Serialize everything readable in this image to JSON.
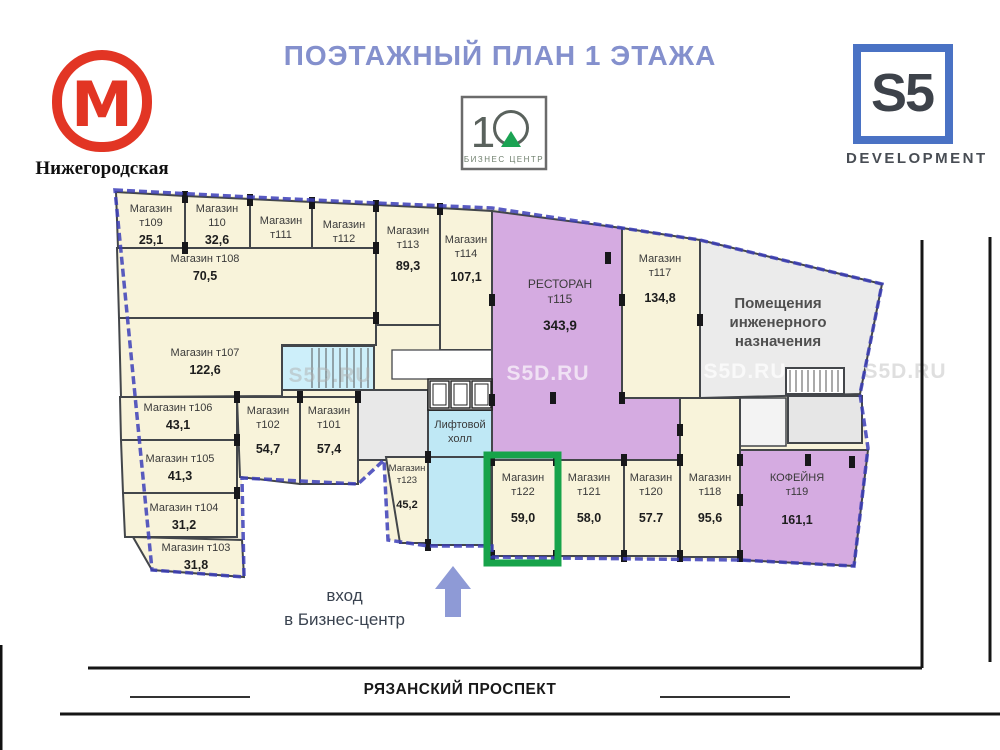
{
  "header": {
    "title": "ПОЭТАЖНЫЙ ПЛАН 1 ЭТАЖА",
    "metro": {
      "letter": "М",
      "station": "Нижегородская"
    },
    "business_center": {
      "digit": "1",
      "caption": "БИЗНЕС ЦЕНТР"
    },
    "developer": {
      "name": "S5",
      "caption": "DEVELOPMENT"
    }
  },
  "entrance": {
    "line1": "вход",
    "line2": "в Бизнес-центр"
  },
  "street": {
    "name": "РЯЗАНСКИЙ ПРОСПЕКТ"
  },
  "watermark_text": "S5D.RU",
  "colors": {
    "metro_red": "#e23524",
    "title_blue": "#8490cd",
    "accent_green": "#17a34a",
    "wall": "#43464a",
    "outline_blue": "#3c3eb8",
    "cream": "#f8f3da",
    "purple": "#d5abe1",
    "gray": "#ebebeb",
    "cyan": "#bfe8f5",
    "arrow_blue": "#8e9ad6"
  },
  "plan": {
    "outline": "115,190 250,197 376,203 492,208 622,228 700,240 882,284 860,394 868,448 854,566 740,560 556,558 492,557 492,546 428,546 388,540 384,460 358,484 242,478 244,577 152,570",
    "rooms": [
      {
        "id": "t109",
        "f": "cream",
        "p": "116,192 185,196 185,248 118,248",
        "n": [
          "Магазин",
          "т109"
        ],
        "a": "25,1",
        "lx": 151,
        "ly": 212,
        "ao": 32
      },
      {
        "id": "t110",
        "f": "cream",
        "p": "185,196 250,199 250,248 185,248",
        "n": [
          "Магазин",
          "110"
        ],
        "a": "32,6",
        "lx": 217,
        "ly": 212,
        "ao": 32
      },
      {
        "id": "t111",
        "f": "cream",
        "p": "250,199 312,202 312,318 250,318",
        "n": [
          "Магазин",
          "т111"
        ],
        "a": "74,9",
        "lx": 281,
        "ly": 224,
        "ao": 36
      },
      {
        "id": "t112",
        "f": "cream",
        "p": "312,202 376,205 376,322 312,322",
        "n": [
          "Магазин",
          "т112"
        ],
        "a": "91,7",
        "lx": 344,
        "ly": 228
      },
      {
        "id": "t113",
        "f": "cream",
        "p": "376,205 440,208 440,325 376,325",
        "n": [
          "Магазин",
          "т113"
        ],
        "a": "89,3",
        "lx": 408,
        "ly": 234,
        "ao": 36
      },
      {
        "id": "t114",
        "f": "cream",
        "p": "440,208 492,211 492,350 440,350",
        "n": [
          "Магазин",
          "т114"
        ],
        "a": "107,1",
        "lx": 466,
        "ly": 243
      },
      {
        "id": "t108",
        "f": "cream",
        "p": "117,248 376,248 376,318 119,318",
        "n": [
          "Магазин т108"
        ],
        "a": "70,5",
        "lx": 205,
        "ly": 262
      },
      {
        "id": "t107",
        "f": "cream",
        "p": "119,318 376,318 376,345 282,345 282,396 121,397",
        "n": [
          "Магазин т107"
        ],
        "a": "122,6",
        "lx": 205,
        "ly": 356
      },
      {
        "id": "t106",
        "f": "cream",
        "p": "120,397 237,397 237,440 121,440",
        "n": [
          "Магазин т106"
        ],
        "a": "43,1",
        "lx": 178,
        "ly": 411
      },
      {
        "id": "t105",
        "f": "cream",
        "p": "121,440 237,440 237,493 123,493",
        "n": [
          "Магазин т105"
        ],
        "a": "41,3",
        "lx": 180,
        "ly": 462
      },
      {
        "id": "t104",
        "f": "cream",
        "p": "123,493 237,493 237,537 125,537",
        "n": [
          "Магазин т104"
        ],
        "a": "31,2",
        "lx": 184,
        "ly": 511
      },
      {
        "id": "t103",
        "f": "cream",
        "p": "133,537 242,540 244,577 152,570",
        "n": [
          "Магазин т103"
        ],
        "a": "31,8",
        "lx": 196,
        "ly": 551
      },
      {
        "id": "t102",
        "f": "cream",
        "p": "237,397 300,397 300,484 240,477",
        "n": [
          "Магазин",
          "т102"
        ],
        "a": "54,7",
        "lx": 268,
        "ly": 414,
        "ao": 39
      },
      {
        "id": "t101",
        "f": "cream",
        "p": "300,397 358,397 358,484 300,484",
        "n": [
          "Магазин",
          "т101"
        ],
        "a": "57,4",
        "lx": 329,
        "ly": 414,
        "ao": 39
      },
      {
        "id": "corridor-west",
        "f": "#e8e8e8",
        "p": "358,390 428,390 428,460 358,460",
        "n": [],
        "a": ""
      },
      {
        "id": "utility-north",
        "f": "#ffffff",
        "p": "392,350 492,350 492,379 392,379",
        "n": [],
        "a": "",
        "sw": 1.3
      },
      {
        "id": "stair-west",
        "f": "#cdeffa",
        "p": "282,346 374,346 374,390 282,390",
        "n": [],
        "a": ""
      },
      {
        "id": "lift-hall",
        "f": "cyan",
        "p": "428,410 492,410 492,457 428,457",
        "n": [
          "Лифтовой",
          "холл"
        ],
        "a": "",
        "lx": 460,
        "ly": 428
      },
      {
        "id": "corridor-south",
        "f": "cyan",
        "p": "428,457 490,457 490,545 428,545",
        "n": [],
        "a": ""
      },
      {
        "id": "t123",
        "f": "cream",
        "p": "386,457 428,457 428,543 400,543",
        "n": [
          "Магазин",
          "т123"
        ],
        "a": "45,2",
        "lx": 407,
        "ly": 471,
        "fs": 9.5,
        "ao": 37
      },
      {
        "id": "restaurant-t115",
        "f": "purple",
        "p": "492,211 622,228 622,398 680,398 680,460 492,460",
        "n": [
          "РЕСТОРАН",
          "т115"
        ],
        "a": "343,9",
        "lx": 560,
        "ly": 288,
        "fs": 12,
        "ao": 42
      },
      {
        "id": "t117",
        "f": "cream",
        "p": "622,228 700,240 700,398 622,398",
        "n": [
          "Магазин",
          "т117"
        ],
        "a": "134,8",
        "lx": 660,
        "ly": 262,
        "ao": 40
      },
      {
        "id": "engineering",
        "f": "gray",
        "p": "700,240 882,284 860,394 700,398",
        "n": [
          "Помещения",
          "инженерного",
          "назначения"
        ],
        "a": "",
        "lx": 778,
        "ly": 308,
        "fs": 15,
        "bold": true,
        "tc": "#4f4f4f"
      },
      {
        "id": "corridor-east",
        "f": "#f3f3f3",
        "p": "700,398 786,398 786,446 700,446",
        "n": [],
        "a": "",
        "sw": 1.5
      },
      {
        "id": "stair-east",
        "f": "#ffffff",
        "p": "786,368 844,368 844,394 786,394",
        "n": [],
        "a": ""
      },
      {
        "id": "utility-east",
        "f": "#e6e6e6",
        "p": "788,396 862,396 862,443 788,443",
        "n": [],
        "a": ""
      },
      {
        "id": "t122",
        "f": "cream",
        "p": "492,460 556,460 556,556 492,556",
        "n": [
          "Магазин",
          "т122"
        ],
        "a": "59,0",
        "lx": 523,
        "ly": 481,
        "ao": 41
      },
      {
        "id": "t121",
        "f": "cream",
        "p": "556,460 624,460 624,556 556,556",
        "n": [
          "Магазин",
          "т121"
        ],
        "a": "58,0",
        "lx": 589,
        "ly": 481,
        "ao": 41
      },
      {
        "id": "t120",
        "f": "cream",
        "p": "624,460 680,460 680,556 624,556",
        "n": [
          "Магазин",
          "т120"
        ],
        "a": "57.7",
        "lx": 651,
        "ly": 481,
        "ao": 41
      },
      {
        "id": "t118",
        "f": "cream",
        "p": "680,398 740,398 740,557 680,557",
        "n": [
          "Магазин",
          "т118"
        ],
        "a": "95,6",
        "lx": 710,
        "ly": 481,
        "ao": 41
      },
      {
        "id": "cafe-t119",
        "f": "purple",
        "p": "740,450 868,450 854,566 740,560",
        "n": [
          "КОФЕЙНЯ",
          "т119"
        ],
        "a": "161,1",
        "lx": 797,
        "ly": 481,
        "ao": 43
      }
    ],
    "highlight": {
      "room": "т122",
      "x": 487,
      "y": 455,
      "w": 71,
      "h": 108
    },
    "piers": [
      [
        185,
        197
      ],
      [
        250,
        200
      ],
      [
        312,
        203
      ],
      [
        376,
        206
      ],
      [
        440,
        209
      ],
      [
        185,
        248
      ],
      [
        376,
        248
      ],
      [
        376,
        318
      ],
      [
        237,
        397
      ],
      [
        300,
        397
      ],
      [
        358,
        397
      ],
      [
        237,
        440
      ],
      [
        237,
        493
      ],
      [
        492,
        300
      ],
      [
        622,
        300
      ],
      [
        622,
        398
      ],
      [
        700,
        320
      ],
      [
        553,
        398
      ],
      [
        608,
        258
      ],
      [
        492,
        400
      ],
      [
        680,
        430
      ],
      [
        492,
        460
      ],
      [
        556,
        460
      ],
      [
        624,
        460
      ],
      [
        680,
        460
      ],
      [
        740,
        460
      ],
      [
        492,
        556
      ],
      [
        556,
        556
      ],
      [
        624,
        556
      ],
      [
        680,
        556
      ],
      [
        740,
        556
      ],
      [
        428,
        457
      ],
      [
        428,
        545
      ],
      [
        740,
        500
      ],
      [
        808,
        460
      ],
      [
        852,
        462
      ]
    ],
    "stairs": [
      {
        "x1": 312,
        "x2": 372,
        "y1": 348,
        "y2": 388,
        "step": 7
      },
      {
        "x1": 790,
        "x2": 842,
        "y1": 370,
        "y2": 392,
        "step": 6
      }
    ],
    "elevators": {
      "container": [
        428,
        379,
        64,
        31
      ],
      "cells": [
        [
          430,
          381,
          19,
          27
        ],
        [
          451,
          381,
          19,
          27
        ],
        [
          472,
          381,
          19,
          27
        ]
      ]
    },
    "watermarks": [
      {
        "x": 330,
        "y": 382,
        "fill": "#b0b0b0",
        "o": 0.5
      },
      {
        "x": 548,
        "y": 380,
        "fill": "#ffffff",
        "o": 0.65
      },
      {
        "x": 745,
        "y": 378,
        "fill": "#ffffff",
        "o": 0.7
      },
      {
        "x": 905,
        "y": 378,
        "fill": "#dcdcdc",
        "o": 0.9
      }
    ],
    "roads": {
      "lines": [
        [
          88,
          668,
          922,
          668
        ],
        [
          60,
          714,
          1000,
          714
        ],
        [
          922,
          240,
          922,
          668
        ],
        [
          990,
          237,
          990,
          662
        ]
      ],
      "dashes": [
        [
          130,
          697,
          250,
          697
        ],
        [
          660,
          697,
          790,
          697
        ]
      ]
    }
  }
}
